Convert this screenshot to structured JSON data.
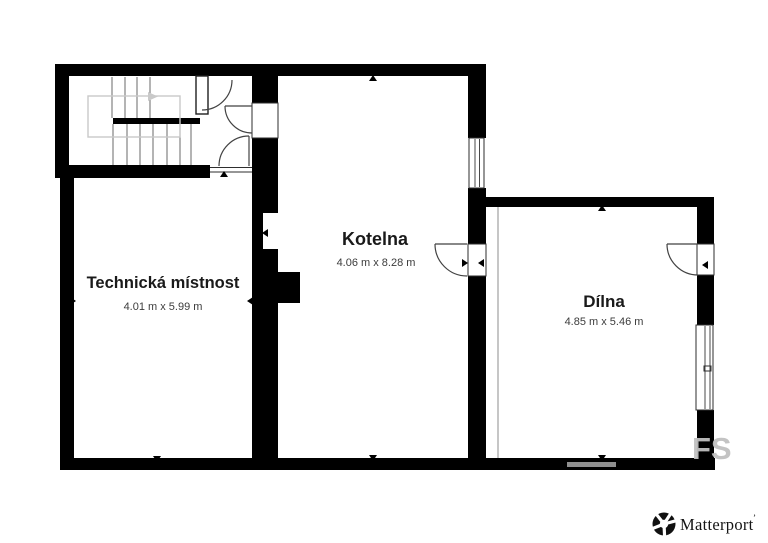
{
  "floorplan": {
    "rooms": [
      {
        "name": "Technická místnost",
        "dimensions": "4.01 m x 5.99 m"
      },
      {
        "name": "Kotelna",
        "dimensions": "4.06 m x 8.28 m"
      },
      {
        "name": "Dílna",
        "dimensions": "4.85 m x 5.46 m"
      }
    ],
    "watermark_text": "FS",
    "colors": {
      "background": "#ffffff",
      "wall": "#000000",
      "room_name": "#1a1a1a",
      "dimension_text": "#3c3c3c",
      "stair_lines": "#777777",
      "walk_path": "#c9c9c9",
      "divider_line": "#b3b3b3",
      "watermark": "#c0c0c0"
    }
  },
  "branding": {
    "logo_icon": "matterport-pinwheel-icon",
    "logo_text": "Matterport",
    "trademark_mark": "’"
  }
}
